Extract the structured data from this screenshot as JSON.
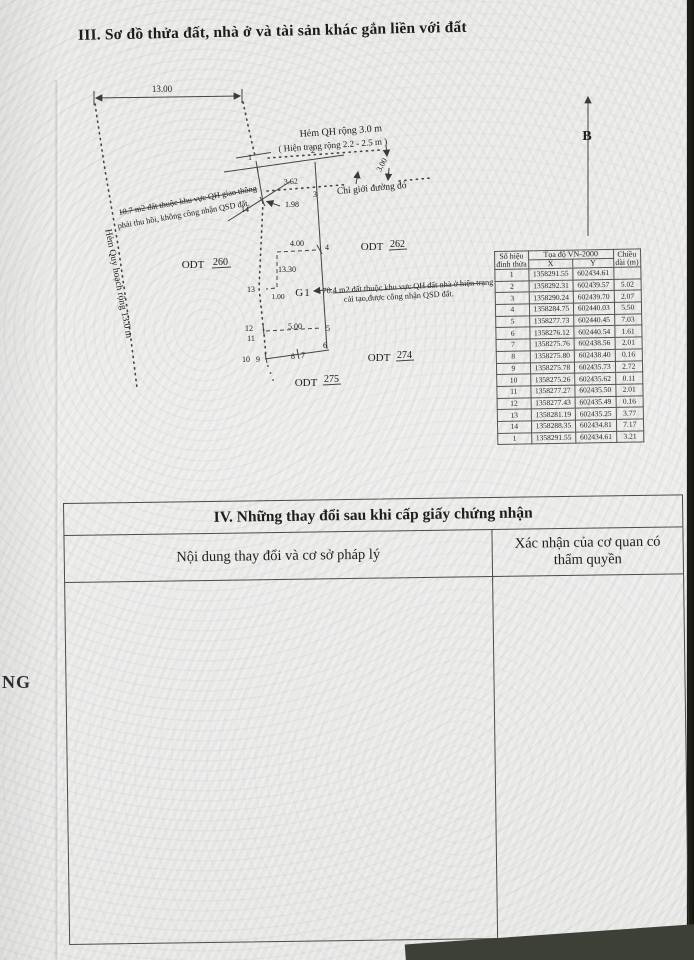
{
  "title": "III. Sơ đồ thửa đất, nhà ở và tài sản khác gắn liền với đất",
  "margin_text": "NG",
  "diagram": {
    "north_label": "B",
    "alley_left": "Hẻm Quy hoạch rộng 13.0 m",
    "street_line1": "Hẻm QH rộng 3.0 m",
    "street_line2": "( Hiện trạng rộng 2.2 - 2.5 m )",
    "red_line": "Chỉ giới đường đỏ",
    "note107_1": "10.7 m2 đất thuộc khu vực QH giao thông",
    "note107_2": "phải thu hồi, không công nhận QSD đất.",
    "note704_1": "70.4 m2 đất thuộc khu vực QH đất nhà ở hiện trạng",
    "note704_2": "cải tạo,được công nhận QSD đất.",
    "g1": "G1",
    "dims": {
      "top": "13.00",
      "street": "3.00",
      "d362": "3.62",
      "d198": "1.98",
      "d400": "4.00",
      "d1330": "13.30",
      "d100": "1.00",
      "d500": "5.00"
    },
    "vertices": {
      "v1": "1",
      "v2": "2",
      "v3": "3",
      "v4": "4",
      "v5": "5",
      "v6": "6",
      "v7": "7",
      "v8": "8",
      "v9": "9",
      "v10": "10",
      "v11": "11",
      "v12": "12",
      "v13": "13",
      "v14": "14"
    },
    "odt": [
      {
        "prefix": "ODT",
        "num": "260"
      },
      {
        "prefix": "ODT",
        "num": "262"
      },
      {
        "prefix": "ODT",
        "num": "274"
      },
      {
        "prefix": "ODT",
        "num": "275"
      }
    ]
  },
  "coord_table": {
    "col_vertex": "Số hiệu đỉnh thửa",
    "col_coords": "Tọa độ VN-2000",
    "col_x": "X",
    "col_y": "Y",
    "col_length": "Chiều dài (m)",
    "rows": [
      [
        "1",
        "1358291.55",
        "602434.61",
        ""
      ],
      [
        "2",
        "1358292.31",
        "602439.57",
        "5.02"
      ],
      [
        "3",
        "1358290.24",
        "602439.70",
        "2.07"
      ],
      [
        "4",
        "1358284.75",
        "602440.03",
        "5.50"
      ],
      [
        "5",
        "1358277.73",
        "602440.45",
        "7.03"
      ],
      [
        "6",
        "1358276.12",
        "602440.54",
        "1.61"
      ],
      [
        "7",
        "1358275.76",
        "602438.56",
        "2.01"
      ],
      [
        "8",
        "1358275.80",
        "602438.40",
        "0.16"
      ],
      [
        "9",
        "1358275.78",
        "602435.73",
        "2.72"
      ],
      [
        "10",
        "1358275.26",
        "602435.62",
        "0.11"
      ],
      [
        "11",
        "1358277.27",
        "602435.50",
        "2.01"
      ],
      [
        "12",
        "1358277.43",
        "602435.49",
        "0.16"
      ],
      [
        "13",
        "1358281.19",
        "602435.25",
        "3.77"
      ],
      [
        "14",
        "1358288.35",
        "602434.81",
        "7.17"
      ],
      [
        "1",
        "1358291.55",
        "602434.61",
        "3.21"
      ]
    ]
  },
  "section4": {
    "title": "IV. Những thay đổi sau khi cấp giấy chứng nhận",
    "col_content": "Nội dung thay đổi và cơ sở pháp lý",
    "col_confirm": "Xác nhận của cơ quan có thẩm quyền"
  }
}
